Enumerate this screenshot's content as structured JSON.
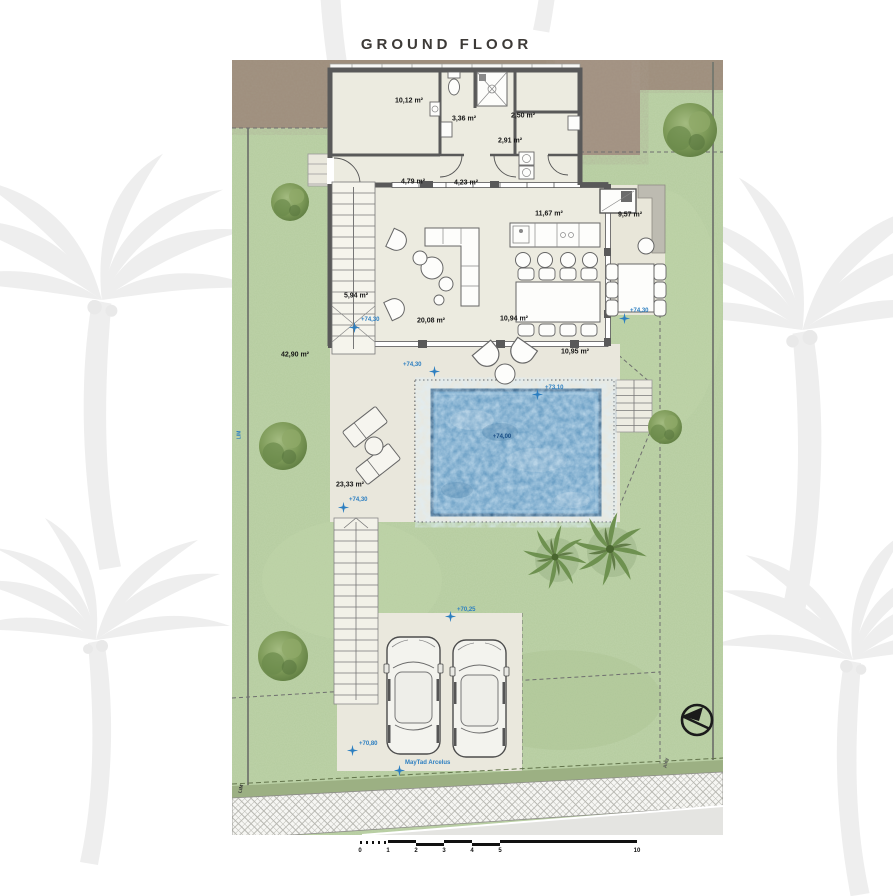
{
  "title": "GROUND FLOOR",
  "rooms": {
    "bedroom": "10,12 m²",
    "bathroom": "3,36 m²",
    "storage": "2,50 m²",
    "laundry": "2,91 m²",
    "hallway": "4,79 m²",
    "entry": "4,23 m²",
    "kitchen": "11,67 m²",
    "bbq_terrace": "9,57 m²",
    "staircase": "5,94 m²",
    "living": "20,08 m²",
    "dining": "10,94 m²",
    "porch": "10,95 m²",
    "side_garden": "42,90 m²",
    "pool_deck": "23,33 m²"
  },
  "elevations": {
    "e1": "+74,30",
    "e2": "+74,30",
    "e3": "+73,10",
    "e4": "+74,30",
    "e5": "+74,00",
    "e6": "+74,30",
    "e7": "+70,25",
    "e8": "+70,80"
  },
  "annotations": {
    "survey_label": "MayTad Arcelus",
    "boundary_left": "LIM",
    "boundary_bottom": "LIM",
    "street_right": "Aley"
  },
  "scalebar": {
    "ticks": [
      "0",
      "1",
      "2",
      "3",
      "4",
      "5",
      "10"
    ]
  },
  "colors": {
    "lawn": "#b4cb9e",
    "dirt": "#9e8e7c",
    "floor": "#ecebe0",
    "deck": "#e9e7dc",
    "wall": "#595959",
    "pool": "#5e96bf",
    "pool_border": "#2f5d84",
    "marker": "#2d7fc1",
    "title_text": "#3d3a37"
  },
  "icons": {
    "north_arrow": "north-arrow-icon",
    "elevation_marker": "survey-star-icon"
  }
}
